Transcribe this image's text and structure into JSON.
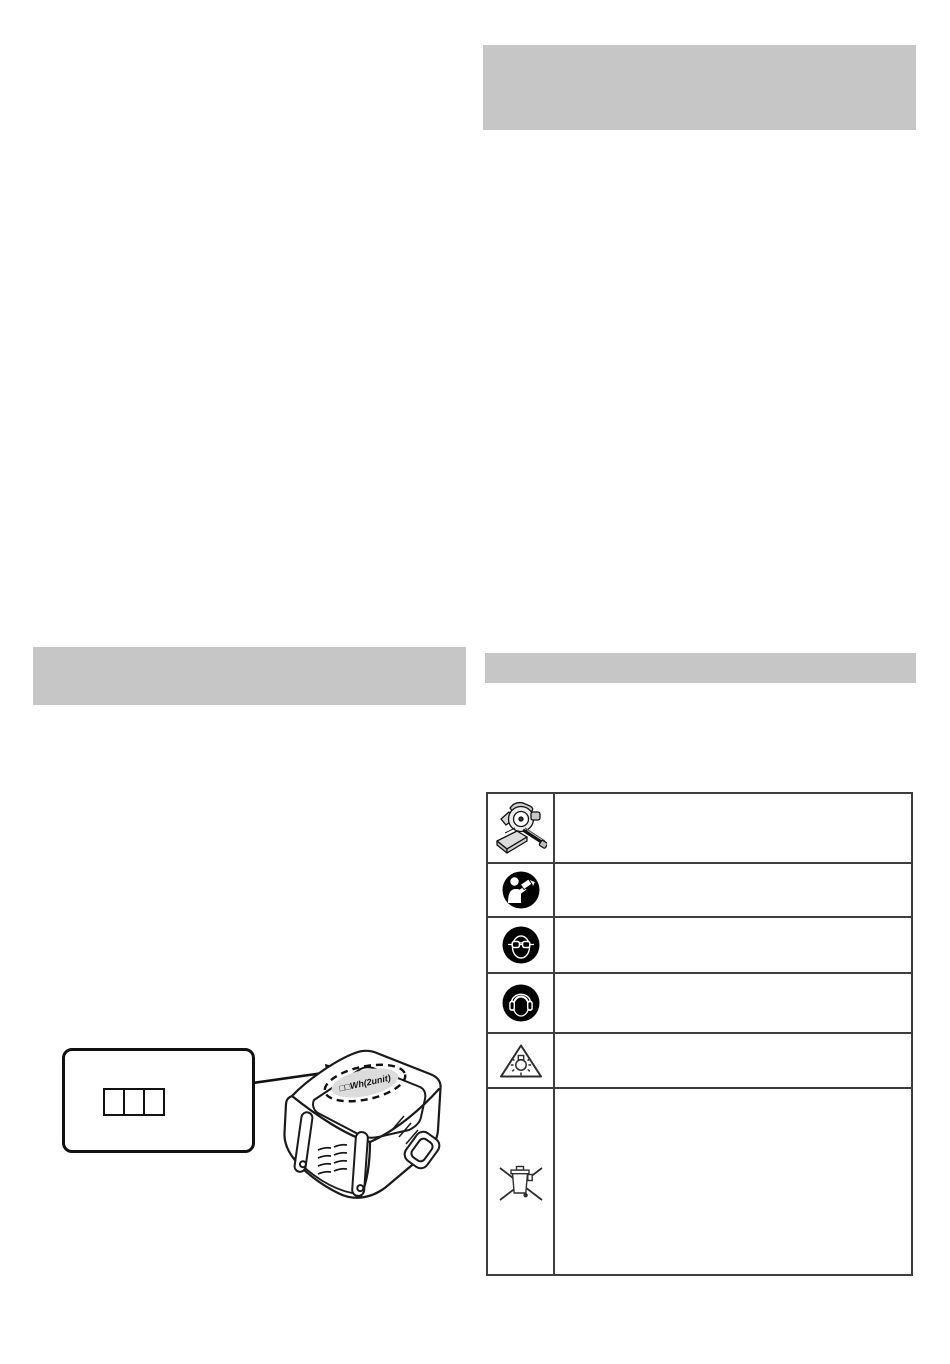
{
  "page": {
    "background": "#ffffff"
  },
  "section_bars": {
    "top_right": {
      "color": "#c6c6c6"
    },
    "mid_left": {
      "color": "#c6c6c6"
    },
    "mid_right": {
      "color": "#c6c6c6"
    }
  },
  "battery_figure": {
    "wh_label": "□□Wh(2unit)",
    "callout_square_count": 3
  },
  "symbol_table": {
    "rows": [
      {
        "icon": "miter-saw-icon",
        "description": ""
      },
      {
        "icon": "read-manual-icon",
        "description": ""
      },
      {
        "icon": "eye-protection-icon",
        "description": ""
      },
      {
        "icon": "ear-protection-icon",
        "description": ""
      },
      {
        "icon": "bright-light-warning-icon",
        "description": ""
      },
      {
        "icon": "weee-crossed-out-bin-icon",
        "description": ""
      }
    ]
  },
  "colors": {
    "bar_gray": "#c6c6c6",
    "table_border": "#3d3d3d",
    "drawing_line": "#1a1a1a",
    "label_ellipse_fill": "#dcdcdc"
  }
}
